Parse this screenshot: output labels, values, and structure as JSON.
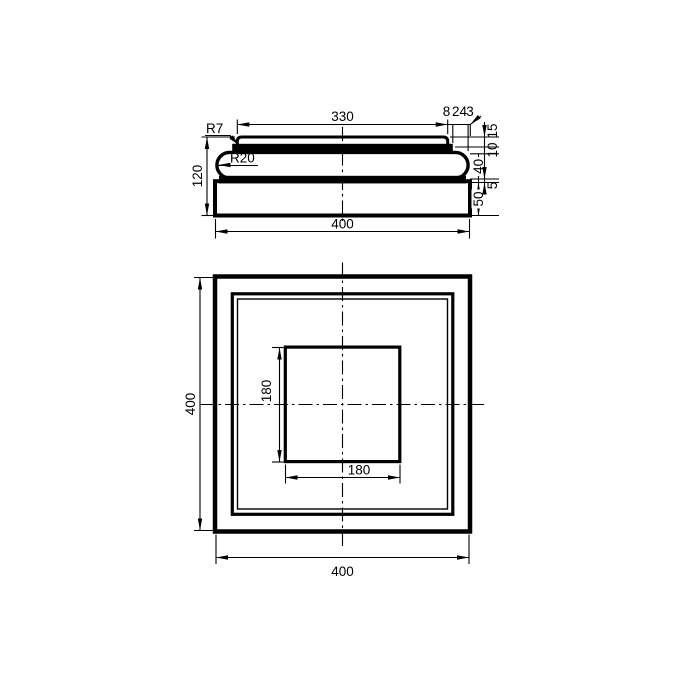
{
  "drawing": {
    "kind": "technical-drawing-column-base",
    "colors": {
      "background": "#ffffff",
      "line_color": "#000000"
    },
    "side_view": {
      "dim_top_width": "330",
      "dim_offset_a": "8",
      "dim_offset_b": "24",
      "dim_offset_c": "3",
      "dim_h_plate": "15",
      "dim_h_band": "10",
      "dim_h_torus": "40",
      "dim_h_fillet": "5",
      "dim_h_plinth": "50",
      "dim_total_height": "120",
      "dim_base_width": "400",
      "radius_plate": "R7",
      "radius_torus": "R20"
    },
    "plan_view": {
      "dim_overall_height": "400",
      "dim_overall_width": "400",
      "dim_inner_height": "180",
      "dim_inner_width": "180"
    }
  }
}
